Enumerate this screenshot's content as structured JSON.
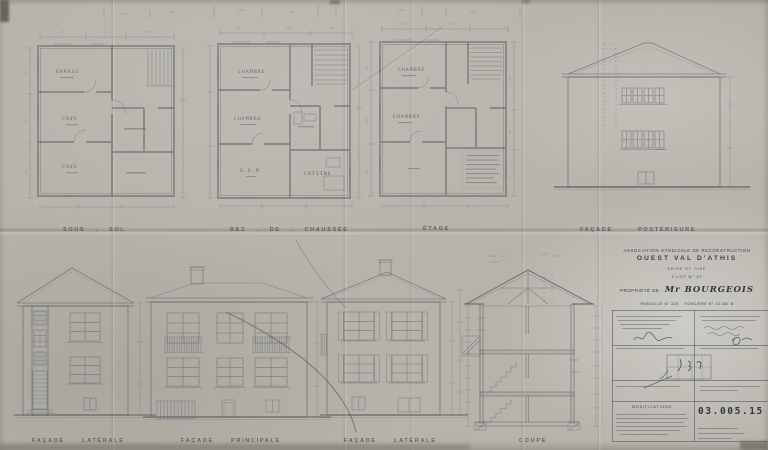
{
  "sheet": {
    "captions": {
      "sous_sol": "SOUS . SOL",
      "rez_de_chaussee": "REZ . DE . CHAUSSÉE",
      "etage": "ÉTAGE",
      "facade_posterieure": "FAÇADE POSTÉRIEURE",
      "facade_laterale_gauche": "FAÇADE LATÉRALE",
      "facade_principale": "FAÇADE PRINCIPALE",
      "facade_laterale_droite": "FAÇADE LATÉRALE",
      "coupe": "COUPE"
    },
    "rooms": {
      "sous_sol": [
        "GARAGE",
        "CAVE",
        "CAVE"
      ],
      "rez_de_chaussee": [
        "CHAMBRE",
        "CHAMBRE",
        "S.A.M.",
        "CUISINE"
      ],
      "etage": [
        "CHAMBRE",
        "CHAMBRE"
      ]
    },
    "title_block": {
      "association": "ASSOCIATION SYNDICALE DE RECONSTRUCTION",
      "sector": "OUEST VAL D'ATHIS",
      "department": "SEINE ET OISE",
      "lot": "2 LOT N° 47",
      "property_label": "PROPRIÉTÉ DE :",
      "owner": "Mr BOURGEOIS",
      "parcel": "PARCELLE N° 320",
      "fonciere": "FONCIÈRE N° 13.381 B",
      "modifications_label": "MODIFICATIONS",
      "drawing_number": "03.005.15"
    },
    "colors": {
      "paper": "#b6b3ab",
      "pencil": "#565b64",
      "ink": "#3f434b"
    }
  }
}
